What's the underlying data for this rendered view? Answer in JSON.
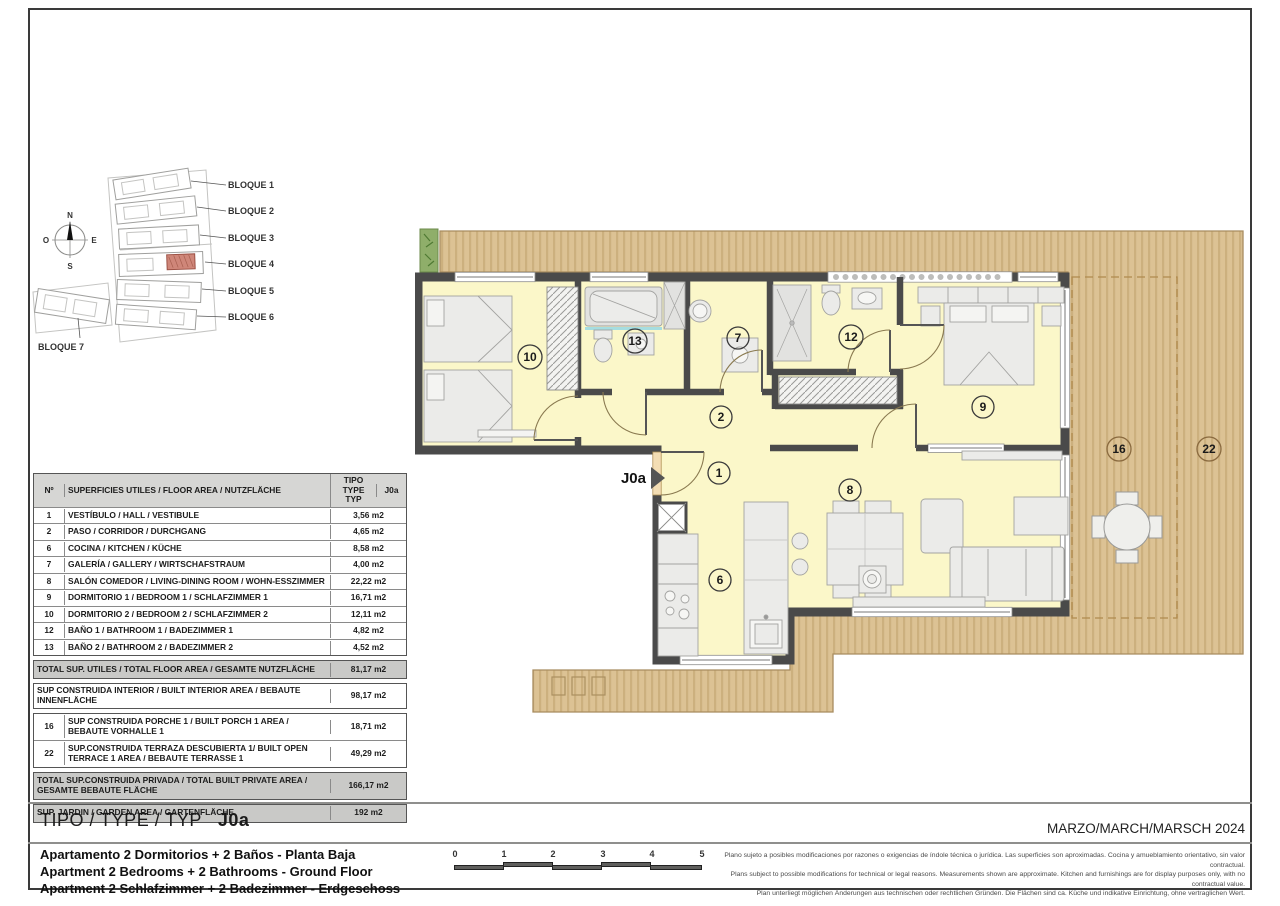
{
  "site_plan": {
    "block_labels": [
      "BLOQUE 1",
      "BLOQUE 2",
      "BLOQUE 3",
      "BLOQUE 4",
      "BLOQUE 5",
      "BLOQUE 6",
      "BLOQUE 7"
    ],
    "compass": {
      "n": "N",
      "e": "E",
      "s": "S",
      "w": "O"
    }
  },
  "area_table": {
    "header": {
      "num": "Nº",
      "desc": "SUPERFICIES UTILES / FLOOR AREA / NUTZFLÄCHE",
      "type": "TIPO TYPE TYP",
      "model": "J0a"
    },
    "rows": [
      {
        "num": "1",
        "desc": "VESTÍBULO / HALL / VESTIBULE",
        "value": "3,56 m2"
      },
      {
        "num": "2",
        "desc": "PASO  / CORRIDOR / DURCHGANG",
        "value": "4,65 m2"
      },
      {
        "num": "6",
        "desc": "COCINA  / KITCHEN / KÜCHE",
        "value": "8,58 m2"
      },
      {
        "num": "7",
        "desc": "GALERÍA / GALLERY / WIRTSCHAFSTRAUM",
        "value": "4,00 m2"
      },
      {
        "num": "8",
        "desc": "SALÓN COMEDOR / LIVING-DINING ROOM / WOHN-ESSZIMMER",
        "value": "22,22 m2"
      },
      {
        "num": "9",
        "desc": "DORMITORIO 1 / BEDROOM 1 / SCHLAFZIMMER 1",
        "value": "16,71 m2"
      },
      {
        "num": "10",
        "desc": "DORMITORIO 2 / BEDROOM 2 / SCHLAFZIMMER 2",
        "value": "12,11 m2"
      },
      {
        "num": "12",
        "desc": "BAÑO 1 / BATHROOM 1 / BADEZIMMER 1",
        "value": "4,82 m2"
      },
      {
        "num": "13",
        "desc": "BAÑO 2 / BATHROOM 2  / BADEZIMMER 2",
        "value": "4,52 m2"
      }
    ],
    "total_utiles": {
      "desc": "TOTAL SUP. UTILES / TOTAL FLOOR AREA / GESAMTE NUTZFLÄCHE",
      "value": "81,17 m2"
    },
    "built_interior": {
      "desc": "SUP CONSTRUIDA INTERIOR / BUILT INTERIOR AREA / BEBAUTE INNENFLÄCHE",
      "value": "98,17 m2"
    },
    "porch": {
      "num": "16",
      "desc": "SUP CONSTRUIDA PORCHE 1 / BUILT PORCH 1 AREA / BEBAUTE VORHALLE 1",
      "value": "18,71 m2"
    },
    "terrace": {
      "num": "22",
      "desc": "SUP.CONSTRUIDA TERRAZA DESCUBIERTA 1/ BUILT OPEN TERRACE  1 AREA / BEBAUTE TERRASSE 1",
      "value": "49,29 m2"
    },
    "total_private": {
      "desc": "TOTAL SUP.CONSTRUIDA PRIVADA / TOTAL  BUILT PRIVATE AREA / GESAMTE BEBAUTE FLÄCHE",
      "value": "166,17 m2"
    },
    "garden": {
      "desc": "SUP. JARDIN / GARDEN AREA / GARTENFLÄCHE",
      "value": "192 m2"
    }
  },
  "floor_plan": {
    "entrance_label": "J0a",
    "rooms": {
      "r1": "1",
      "r2": "2",
      "r6": "6",
      "r7": "7",
      "r8": "8",
      "r9": "9",
      "r10": "10",
      "r12": "12",
      "r13": "13",
      "r16": "16",
      "r22": "22"
    }
  },
  "title_block": {
    "title_label": "TIPO / TYPE / TYP",
    "type_code": "J0a",
    "descriptions": [
      "Apartamento 2 Dormitorios + 2 Baños - Planta Baja",
      "Apartment 2 Bedrooms + 2 Bathrooms - Ground Floor",
      "Apartment 2 Schlafzimmer + 2 Badezimmer - Erdgeschoss"
    ],
    "date": "MARZO/MARCH/MARSCH 2024",
    "scale_ticks": [
      "0",
      "1",
      "2",
      "3",
      "4",
      "5"
    ],
    "disclaimer": [
      "Plano sujeto a posibles modificaciones por razones o exigencias de índole técnica o jurídica. Las superficies son aproximadas. Cocina y amueblamiento orientativo, sin valor contractual.",
      "Plans subject to possible modifications for technical or legal reasons. Measurements shown are approximate. Kitchen and furnishings are for display purposes only, with no contractual value.",
      "Plan unterliegt möglichen Änderungen aus technischen oder rechtlichen Gründen. Die Flächen sind ca. Küche und indikative Einrichtung, ohne vertraglichen Wert."
    ]
  }
}
